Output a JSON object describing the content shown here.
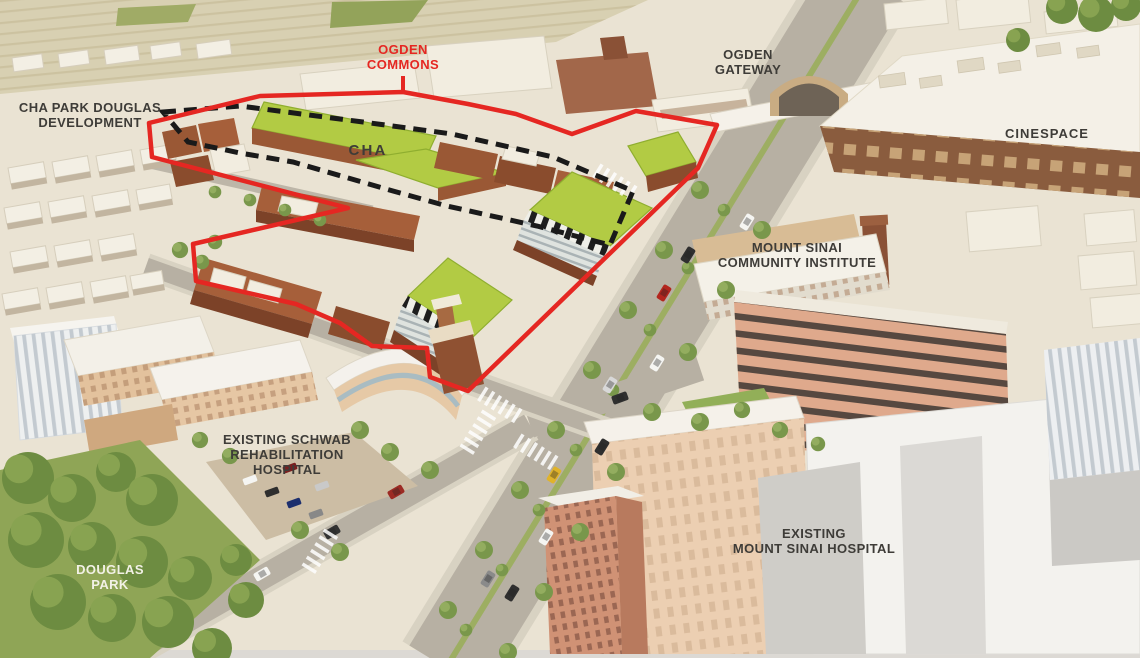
{
  "labels": {
    "cha_park_douglas": {
      "line1": "CHA PARK DOUGLAS",
      "line2": "DEVELOPMENT"
    },
    "ogden_commons": {
      "line1": "OGDEN",
      "line2": "COMMONS"
    },
    "ogden_gateway": {
      "line1": "OGDEN",
      "line2": "GATEWAY"
    },
    "cinespace": {
      "line1": "CINESPACE"
    },
    "cha": {
      "line1": "CHA"
    },
    "mount_sinai_community_institute": {
      "line1": "MOUNT SINAI",
      "line2": "COMMUNITY INSTITUTE"
    },
    "existing_schwab": {
      "line1": "EXISTING SCHWAB",
      "line2": "REHABILITATION",
      "line3": "HOSPITAL"
    },
    "existing_mount_sinai": {
      "line1": "EXISTING",
      "line2": "MOUNT SINAI HOSPITAL"
    },
    "douglas_park": {
      "line1": "DOUGLAS",
      "line2": "PARK"
    }
  },
  "colors": {
    "boundary_red": "#e52722",
    "dashed_black": "#1a1a1a",
    "label_dark": "#3e3c38",
    "label_light": "#f2f1e6",
    "green_roof": "#b2cb44",
    "green_roof_edge": "#8fae2f",
    "cream_bg": "#eae3d3"
  }
}
